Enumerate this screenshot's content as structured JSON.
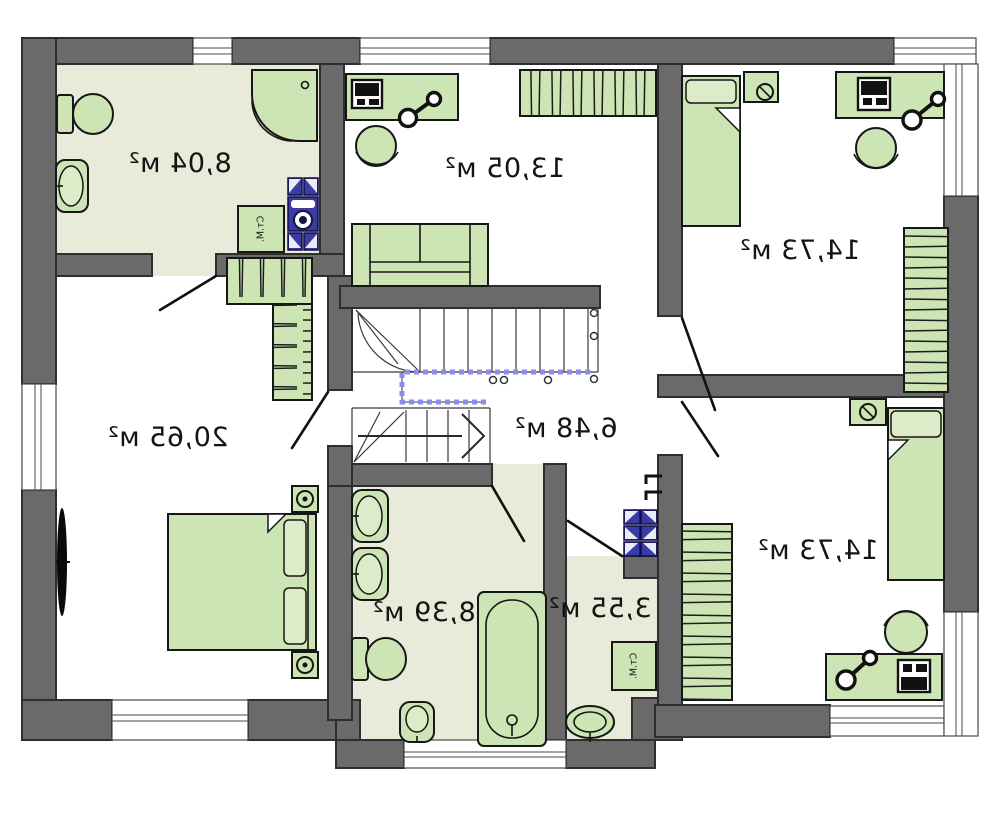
{
  "plan_type": "floor-plan-mirrored",
  "units": "м²",
  "rooms": [
    {
      "id": "bathroom-top-left",
      "area": "8,04 м²"
    },
    {
      "id": "room-top-middle",
      "area": "13,05 м²"
    },
    {
      "id": "bedroom-top-right",
      "area": "14,73 м²"
    },
    {
      "id": "bedroom-left",
      "area": "20,65 м²"
    },
    {
      "id": "hallway-stairs",
      "area": "6,48 м²"
    },
    {
      "id": "bathroom-bottom",
      "area": "8,39 м²"
    },
    {
      "id": "laundry",
      "area": "3,55 м²"
    },
    {
      "id": "bedroom-bottom-right",
      "area": "14,73 м²"
    }
  ],
  "labels": {
    "washing_machine": "Ст.М."
  },
  "colors": {
    "wall": "#6a6a6a",
    "wall_outline": "#2e2e2e",
    "bath_floor": "#e9ebda",
    "furniture_green": "#cde4b4",
    "appliance_blue": "#3b3ba6",
    "stair_railing_blue": "#8b8bf0",
    "background": "#ffffff"
  }
}
